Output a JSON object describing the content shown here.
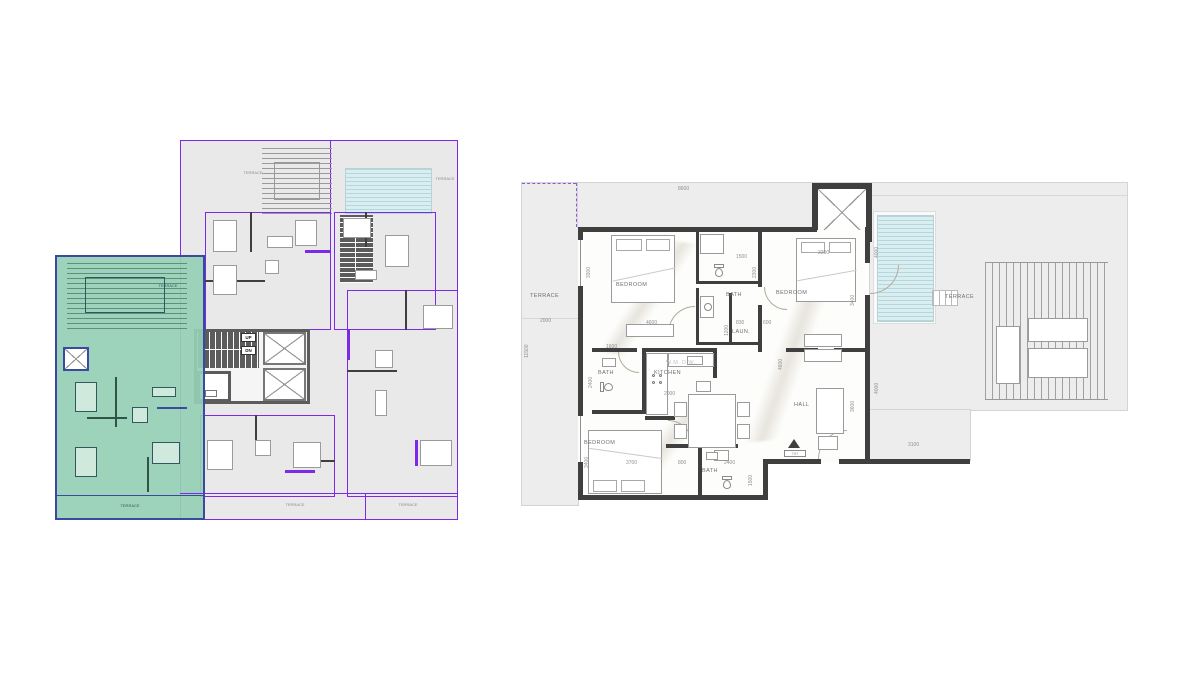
{
  "left_plan": {
    "core": {
      "up": "UP",
      "dn": "DN",
      "dn_top": "DN"
    },
    "terrace_band": [
      {
        "label": "TERRACE"
      },
      {
        "label": "TERRACE"
      },
      {
        "label": "TERRACE"
      }
    ],
    "roof_labels": [
      {
        "label": "TERRACE"
      },
      {
        "label": "TERRACE"
      },
      {
        "label": "TERRACE"
      }
    ],
    "colors": {
      "background": "#e9e9e9",
      "unit_outline": "#7d2ae8",
      "selected_fill": "#96cfb5",
      "selected_outline": "#3a4a9f",
      "wall": "#3f3f3f"
    }
  },
  "right_plan": {
    "rooms": {
      "bedroom1": "BEDROOM",
      "bedroom2": "BEDROOM",
      "bedroom3": "BEDROOM",
      "bath1": "BATH",
      "bath2": "BATH",
      "bath3": "BATH",
      "laundry": "LAUN.",
      "kitchen": "KITCHEN",
      "hall": "HALL",
      "terrace_left": "TERRACE",
      "terrace_right": "TERRACE"
    },
    "appliances": "W.M. D.W.",
    "unit_number": "707",
    "dims": {
      "top": "8600",
      "terrace_width": "2000",
      "left_height": "11500",
      "bed1_window": "3300",
      "bed1_width": "4600",
      "shower": "1500",
      "bath1_side": "2300",
      "laun_width": "830",
      "closet": "600",
      "laun_height": "1200",
      "bath2_width": "1600",
      "bath2_side": "2400",
      "kitchen_width": "2000",
      "bed3_side": "3400",
      "bed3_width": "3700",
      "closet2": "800",
      "bath3_width": "2400",
      "bath3_side": "1500",
      "bed2_width": "3200",
      "bed2_side": "3400",
      "hall_left": "4600",
      "hall_right": "3600",
      "terrace_right_side": "4000",
      "pool_side": "4000",
      "terrace_bottom": "3100"
    },
    "colors": {
      "wall": "#3f3f3f",
      "terrace_fill": "#ededed",
      "pool_fill": "#d9eef1"
    }
  }
}
